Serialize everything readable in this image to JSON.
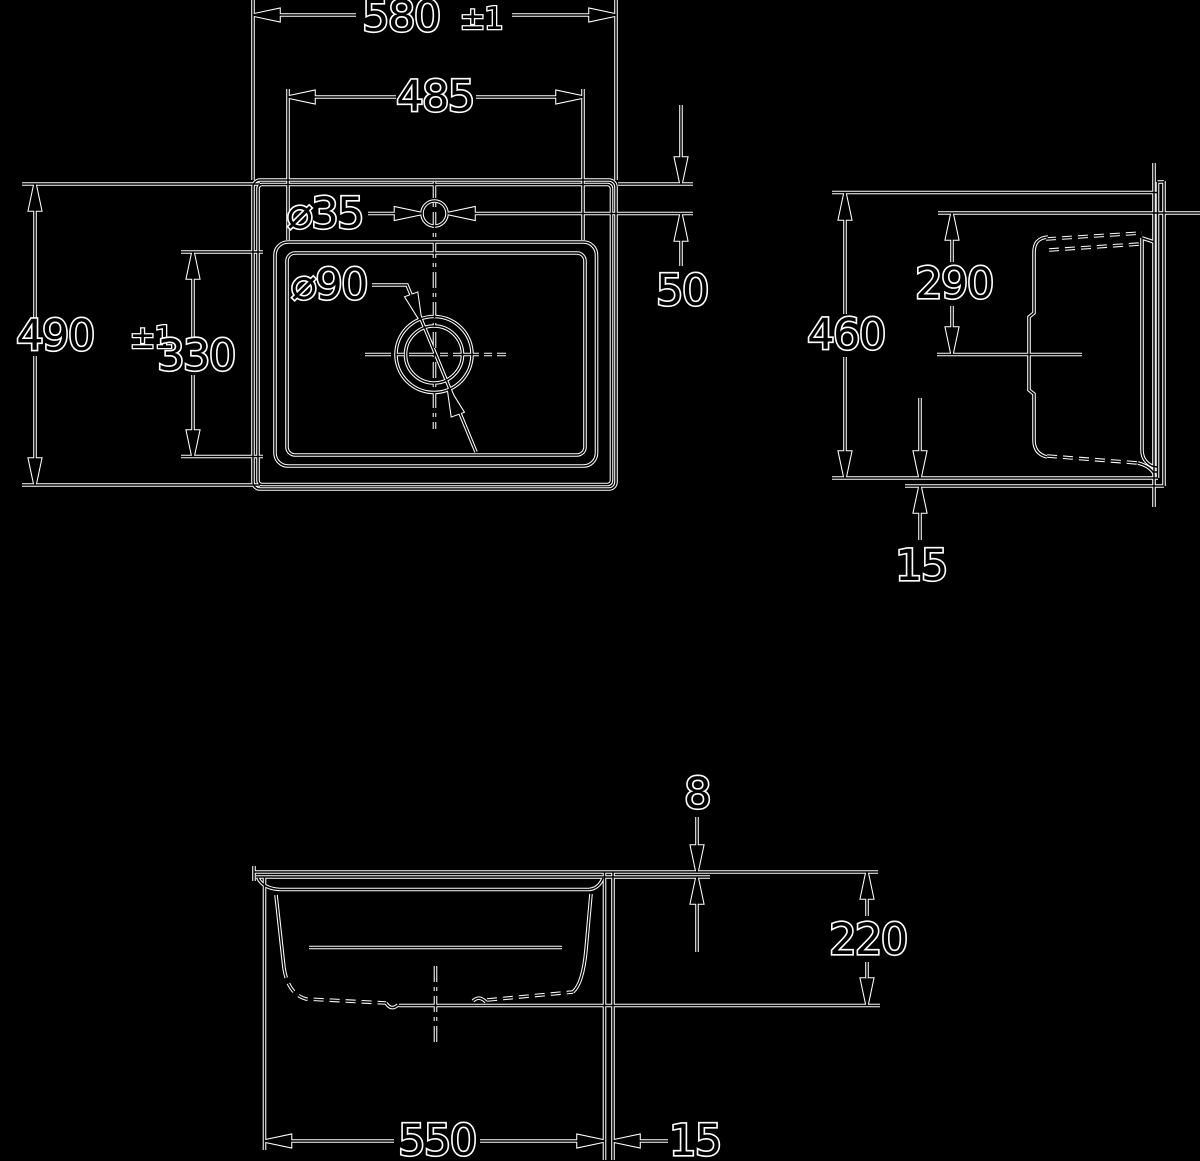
{
  "drawing": {
    "kind": "sink-dimension-drawing",
    "colors": {
      "background": "#000000",
      "ink": "#000000",
      "outline": "#ffffff"
    }
  },
  "labels": {
    "overall_width": "580",
    "overall_width_tol": "±1",
    "bowl_width": "485",
    "tap_hole_diameter": "⌀35",
    "drain_diameter": "⌀90",
    "overall_depth": "490",
    "overall_depth_tol": "±1",
    "bowl_depth": "330",
    "tap_hole_offset": "50",
    "side_depth": "460",
    "drain_center_offset": "290",
    "side_edge_lip": "15",
    "rim_thickness": "8",
    "bowl_height": "220",
    "bowl_bottom_width": "550",
    "edge_width": "15"
  }
}
